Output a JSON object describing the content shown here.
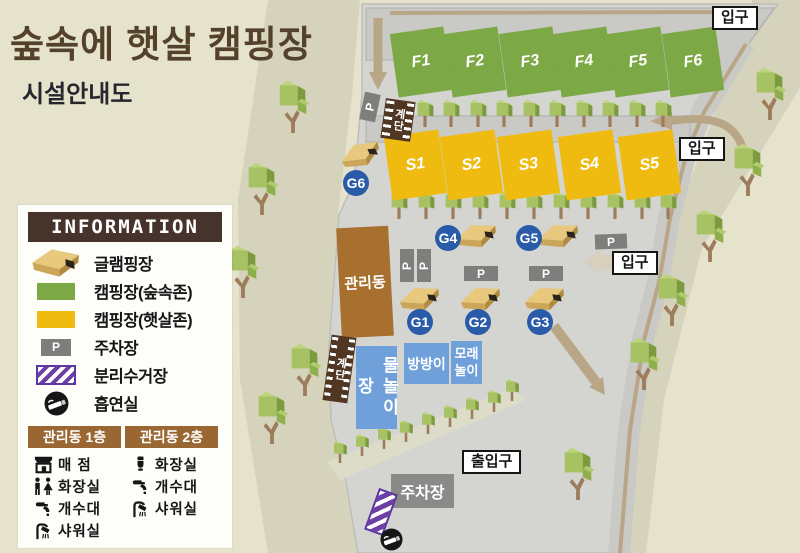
{
  "title": "숲속에 햇살 캠핑장",
  "subtitle": "시설안내도",
  "colors": {
    "background": "#E6E3CC",
    "land": "#D4D4D1",
    "road": "#C9C9C6",
    "path_tan": "#B9A687",
    "forest_zone": "#7CA845",
    "sun_zone": "#EFBB10",
    "glamping_badge": "#2A5BA9",
    "facility_blue": "#6FA0DA",
    "building_brown": "#A8702F",
    "header_brown": "#46332B",
    "sub_header_brown": "#9A6733",
    "parking_gray": "#7E7E7C",
    "recycle_purple": "#6B3FA3",
    "title_brown": "#54412B"
  },
  "legend": {
    "header": "INFORMATION",
    "parking_letter": "P",
    "items": [
      {
        "icon": "glamping-house-icon",
        "label": "글램핑장"
      },
      {
        "icon": "forest-zone-swatch",
        "label": "캠핑장(숲속존)"
      },
      {
        "icon": "sun-zone-swatch",
        "label": "캠핑장(햇살존)"
      },
      {
        "icon": "parking-swatch",
        "label": "주차장"
      },
      {
        "icon": "recycling-swatch",
        "label": "분리수거장"
      },
      {
        "icon": "smoking-icon",
        "label": "흡연실"
      }
    ],
    "buildings": [
      {
        "header": "관리동 1층",
        "rows": [
          {
            "icon": "store-icon",
            "label": "매 점"
          },
          {
            "icon": "restroom-icon",
            "label": "화장실"
          },
          {
            "icon": "faucet-icon",
            "label": "개수대"
          },
          {
            "icon": "shower-icon",
            "label": "샤워실"
          }
        ]
      },
      {
        "header": "관리동 2층",
        "rows": [
          {
            "icon": "toilet-icon",
            "label": "화장실"
          },
          {
            "icon": "faucet-icon",
            "label": "개수대"
          },
          {
            "icon": "shower-icon",
            "label": "샤워실"
          }
        ]
      }
    ]
  },
  "map": {
    "forest_sites": [
      {
        "label": "F1",
        "x": 394,
        "y": 30
      },
      {
        "label": "F2",
        "x": 448,
        "y": 30
      },
      {
        "label": "F3",
        "x": 503,
        "y": 30
      },
      {
        "label": "F4",
        "x": 557,
        "y": 30
      },
      {
        "label": "F5",
        "x": 611,
        "y": 30
      },
      {
        "label": "F6",
        "x": 666,
        "y": 30
      }
    ],
    "sun_sites": [
      {
        "label": "S1",
        "x": 388,
        "y": 133
      },
      {
        "label": "S2",
        "x": 444,
        "y": 133
      },
      {
        "label": "S3",
        "x": 501,
        "y": 133
      },
      {
        "label": "S4",
        "x": 562,
        "y": 133
      },
      {
        "label": "S5",
        "x": 622,
        "y": 133
      }
    ],
    "glamping_badges": [
      {
        "label": "G1",
        "x": 407,
        "y": 309
      },
      {
        "label": "G2",
        "x": 465,
        "y": 309
      },
      {
        "label": "G3",
        "x": 527,
        "y": 309
      },
      {
        "label": "G4",
        "x": 435,
        "y": 225
      },
      {
        "label": "G5",
        "x": 516,
        "y": 225
      },
      {
        "label": "G6",
        "x": 343,
        "y": 170
      }
    ],
    "glamping_houses": [
      {
        "x": 398,
        "y": 285,
        "rot": -14
      },
      {
        "x": 459,
        "y": 285,
        "rot": -14
      },
      {
        "x": 523,
        "y": 285,
        "rot": -14
      },
      {
        "x": 455,
        "y": 222,
        "rot": -14
      },
      {
        "x": 537,
        "y": 222,
        "rot": -14
      },
      {
        "x": 339,
        "y": 141,
        "rot": -24
      }
    ],
    "parking_letter": "P",
    "parking_signs": [
      {
        "x": 362,
        "y": 93,
        "w": 16,
        "h": 28,
        "rot": 12,
        "text_rot": -90
      },
      {
        "x": 400,
        "y": 249,
        "w": 14,
        "h": 33,
        "rot": 0,
        "text_rot": -90
      },
      {
        "x": 417,
        "y": 249,
        "w": 14,
        "h": 33,
        "rot": 0,
        "text_rot": -90
      },
      {
        "x": 464,
        "y": 266,
        "w": 34,
        "h": 15,
        "rot": 0,
        "text_rot": 0
      },
      {
        "x": 529,
        "y": 266,
        "w": 34,
        "h": 15,
        "rot": 0,
        "text_rot": 0
      },
      {
        "x": 595,
        "y": 234,
        "w": 32,
        "h": 15,
        "rot": -2,
        "text_rot": 0
      }
    ],
    "stairs_label": "계단",
    "stairs": [
      {
        "x": 383,
        "y": 100,
        "w": 30,
        "h": 40,
        "rot": 8
      },
      {
        "x": 327,
        "y": 336,
        "w": 25,
        "h": 66,
        "rot": 8
      }
    ],
    "facilities": [
      {
        "label": "물놀이장",
        "x": 356,
        "y": 346,
        "w": 41,
        "h": 83,
        "mode": "vertical"
      },
      {
        "label": "방방이",
        "x": 404,
        "y": 343,
        "w": 45,
        "h": 41,
        "mode": "row"
      },
      {
        "label": "모래놀이",
        "x": 451,
        "y": 341,
        "w": 31,
        "h": 43,
        "mode": "wrap"
      }
    ],
    "management": {
      "label": "관리동",
      "x": 339,
      "y": 227,
      "w": 52,
      "h": 110
    },
    "parking_lot": {
      "label": "주차장",
      "x": 391,
      "y": 474,
      "w": 63,
      "h": 34
    },
    "area_labels": [
      {
        "text": "입구",
        "x": 712,
        "y": 6
      },
      {
        "text": "입구",
        "x": 679,
        "y": 137
      },
      {
        "text": "입구",
        "x": 612,
        "y": 251
      },
      {
        "text": "출입구",
        "x": 462,
        "y": 450
      }
    ],
    "recycling": {
      "x": 371,
      "y": 490
    },
    "smoking": {
      "x": 380,
      "y": 528
    },
    "trees": {
      "row1": [
        [
          398,
          127
        ],
        [
          425,
          127
        ],
        [
          451,
          127
        ],
        [
          478,
          127
        ],
        [
          504,
          127
        ],
        [
          531,
          127
        ],
        [
          557,
          127
        ],
        [
          584,
          127
        ],
        [
          610,
          127
        ],
        [
          637,
          127
        ],
        [
          663,
          127
        ]
      ],
      "row2": [
        [
          399,
          219
        ],
        [
          426,
          219
        ],
        [
          453,
          219
        ],
        [
          480,
          219
        ],
        [
          507,
          219
        ],
        [
          534,
          219
        ],
        [
          561,
          219
        ],
        [
          588,
          219
        ],
        [
          615,
          219
        ],
        [
          642,
          219
        ],
        [
          668,
          219
        ]
      ],
      "walkway": [
        [
          340,
          463
        ],
        [
          362,
          456
        ],
        [
          384,
          449
        ],
        [
          406,
          442
        ],
        [
          428,
          434
        ],
        [
          450,
          427
        ],
        [
          472,
          419
        ],
        [
          494,
          412
        ],
        [
          512,
          401
        ]
      ],
      "left": [
        [
          293,
          133
        ],
        [
          262,
          215
        ],
        [
          243,
          298
        ],
        [
          305,
          396
        ],
        [
          272,
          444
        ]
      ],
      "right": [
        [
          770,
          120
        ],
        [
          748,
          196
        ],
        [
          710,
          262
        ],
        [
          672,
          326
        ],
        [
          644,
          390
        ],
        [
          578,
          500
        ]
      ]
    }
  }
}
